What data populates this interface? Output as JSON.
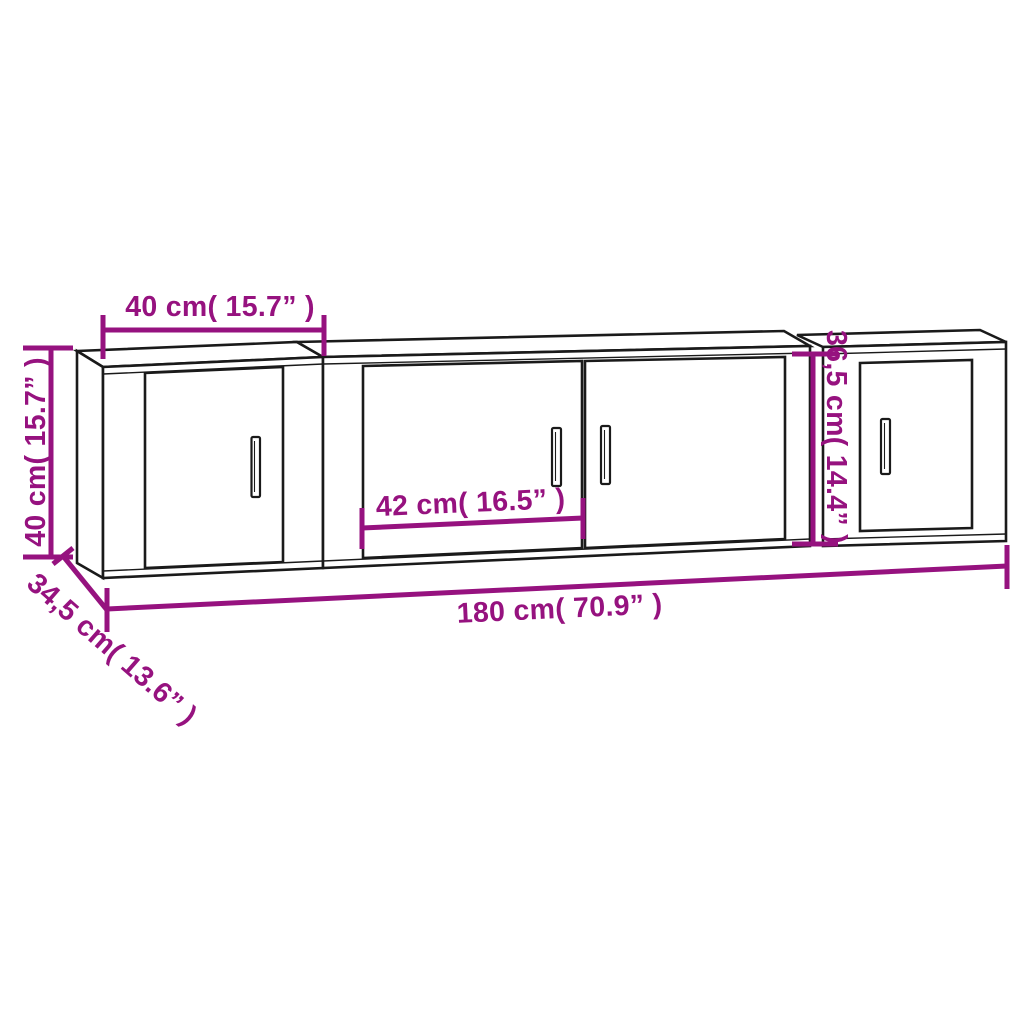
{
  "diagram": {
    "colors": {
      "dimension_accent": "#96127F",
      "outline": "#1a1a1a",
      "background": "#ffffff"
    },
    "labels": {
      "left_cabinet_width": "40 cm( 15.7” )",
      "left_cabinet_height": "40 cm( 15.7” )",
      "middle_door_width": "42 cm( 16.5” )",
      "right_cabinet_height": "36,5 cm( 14.4” )",
      "total_width": "180 cm( 70.9” )",
      "cabinet_depth": "34,5 cm( 13.6” )"
    }
  }
}
